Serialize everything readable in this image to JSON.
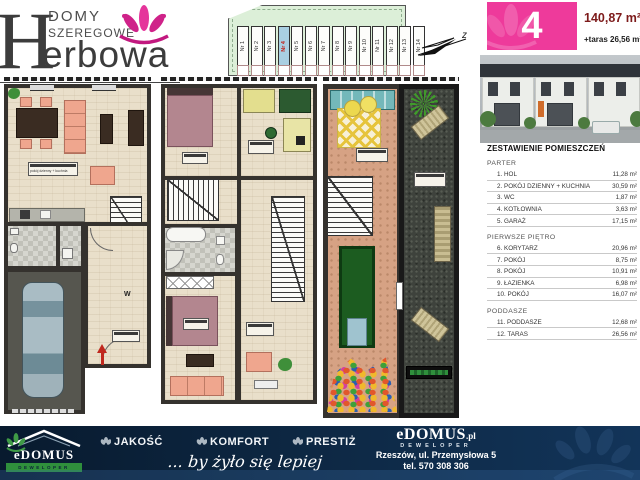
{
  "colors": {
    "accent_pink": "#ee3a9b",
    "dark_red": "#7d1b1b",
    "navy": "#0d2742",
    "green": "#2f8f3c",
    "site_green": "#dcefd8",
    "highlight_blue": "#a9cfe2"
  },
  "logo": {
    "line1": "DOMY",
    "line2": "SZEREGOWE",
    "big_letter": "H",
    "name_rest": "erbowa"
  },
  "site_plan": {
    "units": [
      "Nr 1",
      "Nr 2",
      "Nr 3",
      "Nr 4",
      "Nr 5",
      "Nr 6",
      "Nr 7",
      "Nr 8",
      "Nr 9",
      "Nr 10",
      "Nr 11",
      "Nr 12",
      "Nr 13",
      "Nr 14"
    ],
    "highlighted": "Nr 4",
    "compass_label": "z"
  },
  "unit_info": {
    "number": "4",
    "area": "140,87 m²",
    "terrace": "+taras 26,56 m²"
  },
  "room_list": {
    "title": "ZESTAWIENIE POMIESZCZEŃ",
    "sections": [
      {
        "name": "PARTER",
        "items": [
          {
            "label": "1. HOL",
            "area": "11,28 m²"
          },
          {
            "label": "2. POKÓJ DZIENNY + KUCHNIA",
            "area": "30,59 m²"
          },
          {
            "label": "3. WC",
            "area": "1,87 m²"
          },
          {
            "label": "4. KOTŁOWNIA",
            "area": "3,63 m²"
          },
          {
            "label": "5. GARAŻ",
            "area": "17,15 m²"
          }
        ]
      },
      {
        "name": "PIERWSZE PIĘTRO",
        "items": [
          {
            "label": "6. KORYTARZ",
            "area": "20,96 m²"
          },
          {
            "label": "7. POKÓJ",
            "area": "8,75 m²"
          },
          {
            "label": "8. POKÓJ",
            "area": "10,91 m²"
          },
          {
            "label": "9. ŁAZIENKA",
            "area": "6,98 m²"
          },
          {
            "label": "10. POKÓJ",
            "area": "16,07 m²"
          }
        ]
      },
      {
        "name": "PODDASZE",
        "items": [
          {
            "label": "11. PODDASZE",
            "area": "12,68 m²"
          },
          {
            "label": "12. TARAS",
            "area": "26,56 m²"
          }
        ]
      }
    ]
  },
  "plan_labels": {
    "living_room": "pokój dzienny + kuchnia",
    "entrance": "W"
  },
  "footer": {
    "values": [
      "JAKOŚĆ",
      "KOMFORT",
      "PRESTIŻ"
    ],
    "slogan": "... by żyło się lepiej",
    "brand": "eDOMUS",
    "brand_tld": ".pl",
    "brand_role": "DEWELOPER",
    "address": "Rzeszów, ul. Przemysłowa 5",
    "phone": "tel. 570 308 306",
    "logo_text": "eDOMUS",
    "logo_sub": "DEWELOPER"
  }
}
